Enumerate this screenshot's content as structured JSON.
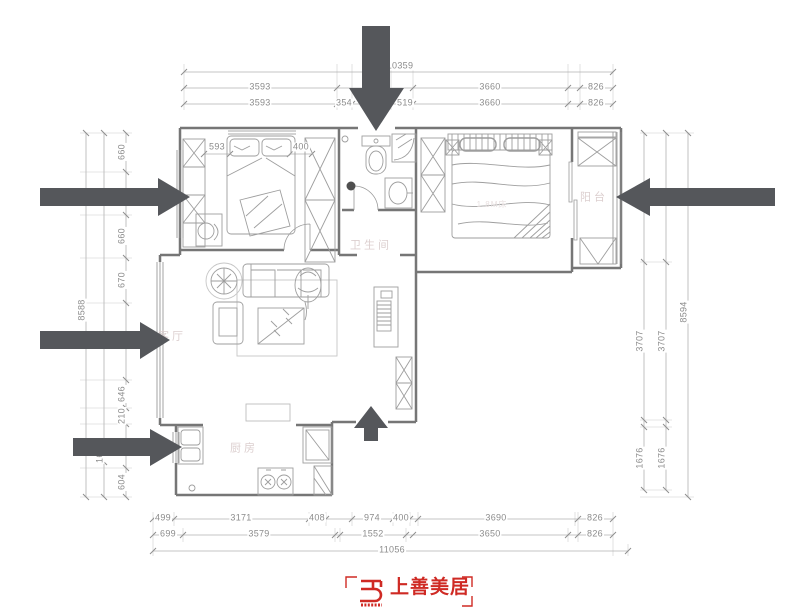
{
  "logo": {
    "text": "上善美居",
    "icon_name": "shangshan-logo-icon"
  },
  "room_labels": [
    {
      "text": "卫生间",
      "x": 371,
      "y": 246
    },
    {
      "text": "阳台",
      "x": 594,
      "y": 198
    },
    {
      "text": "客厅",
      "x": 172,
      "y": 337
    },
    {
      "text": "厨房",
      "x": 244,
      "y": 449
    },
    {
      "text": "1.8M床",
      "x": 492,
      "y": 205,
      "cls": "bedlabel"
    }
  ],
  "dim_labels": [
    {
      "t": "10359",
      "x": 400,
      "y": 66
    },
    {
      "t": "3593",
      "x": 260,
      "y": 87
    },
    {
      "t": "3660",
      "x": 490,
      "y": 87
    },
    {
      "t": "826",
      "x": 596,
      "y": 87
    },
    {
      "t": "3593",
      "x": 260,
      "y": 103
    },
    {
      "t": "354",
      "x": 344,
      "y": 103
    },
    {
      "t": "519",
      "x": 405,
      "y": 103
    },
    {
      "t": "3660",
      "x": 490,
      "y": 103
    },
    {
      "t": "826",
      "x": 596,
      "y": 103
    },
    {
      "t": "593",
      "x": 217,
      "y": 147
    },
    {
      "t": "400",
      "x": 301,
      "y": 147
    },
    {
      "t": "499",
      "x": 163,
      "y": 518
    },
    {
      "t": "3171",
      "x": 241,
      "y": 518
    },
    {
      "t": "408",
      "x": 317,
      "y": 518
    },
    {
      "t": "974",
      "x": 372,
      "y": 518
    },
    {
      "t": "400",
      "x": 401,
      "y": 518
    },
    {
      "t": "3690",
      "x": 496,
      "y": 518
    },
    {
      "t": "826",
      "x": 595,
      "y": 518
    },
    {
      "t": "699",
      "x": 168,
      "y": 534
    },
    {
      "t": "3579",
      "x": 259,
      "y": 534
    },
    {
      "t": "1552",
      "x": 373,
      "y": 534
    },
    {
      "t": "3650",
      "x": 490,
      "y": 534
    },
    {
      "t": "826",
      "x": 595,
      "y": 534
    },
    {
      "t": "11056",
      "x": 392,
      "y": 550
    },
    {
      "t": "8588",
      "x": 82,
      "y": 310,
      "r": 1
    },
    {
      "t": "167",
      "x": 100,
      "y": 455,
      "r": 1
    },
    {
      "t": "660",
      "x": 122,
      "y": 152,
      "r": 1
    },
    {
      "t": "660",
      "x": 122,
      "y": 236,
      "r": 1
    },
    {
      "t": "670",
      "x": 122,
      "y": 280,
      "r": 1
    },
    {
      "t": "646",
      "x": 122,
      "y": 394,
      "r": 1
    },
    {
      "t": "210",
      "x": 122,
      "y": 416,
      "r": 1
    },
    {
      "t": "604",
      "x": 122,
      "y": 482,
      "r": 1
    },
    {
      "t": "3707",
      "x": 640,
      "y": 341,
      "r": 1
    },
    {
      "t": "1676",
      "x": 640,
      "y": 458,
      "r": 1
    },
    {
      "t": "3707",
      "x": 662,
      "y": 341,
      "r": 1
    },
    {
      "t": "1676",
      "x": 662,
      "y": 458,
      "r": 1
    },
    {
      "t": "8594",
      "x": 684,
      "y": 312,
      "r": 1
    }
  ],
  "colors": {
    "arrow": "#55575b",
    "wall": "#767676",
    "dim_line": "#b3b3b3",
    "furniture": "#9e9e9e",
    "room_label": "#dccfcf",
    "logo_red": "#cf2a24"
  }
}
